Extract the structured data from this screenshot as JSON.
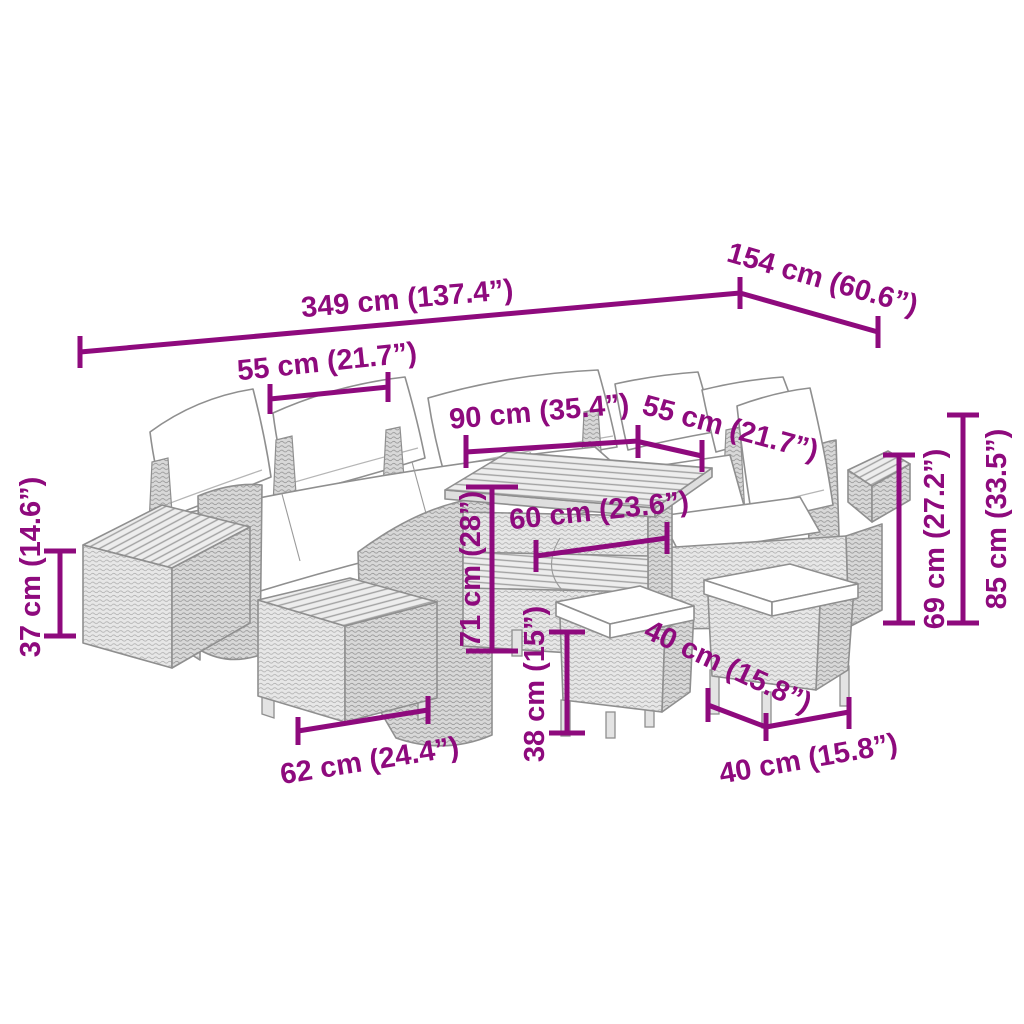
{
  "diagram": {
    "colors": {
      "dimension": "#8E0A7D",
      "furniture_line": "#8f8f8f",
      "background": "#ffffff"
    },
    "labels": {
      "overall_width": "349 cm (137.4”)",
      "overall_depth": "154 cm (60.6”)",
      "seat_section_width_left": "55 cm (21.7”)",
      "table_top_width": "90 cm (35.4”)",
      "seat_section_width_right": "55 cm (21.7”)",
      "table_top_depth": "60 cm (23.6”)",
      "table_height": "71 cm (28”)",
      "side_table_height": "37 cm (14.6”)",
      "backrest_height": "69 cm (27.2”)",
      "total_height": "85 cm (33.5”)",
      "footstool_width": "62 cm (24.4”)",
      "stool_height": "38 cm (15”)",
      "stool_depth": "40 cm (15.8”)",
      "stool_width": "40 cm (15.8”)"
    }
  }
}
